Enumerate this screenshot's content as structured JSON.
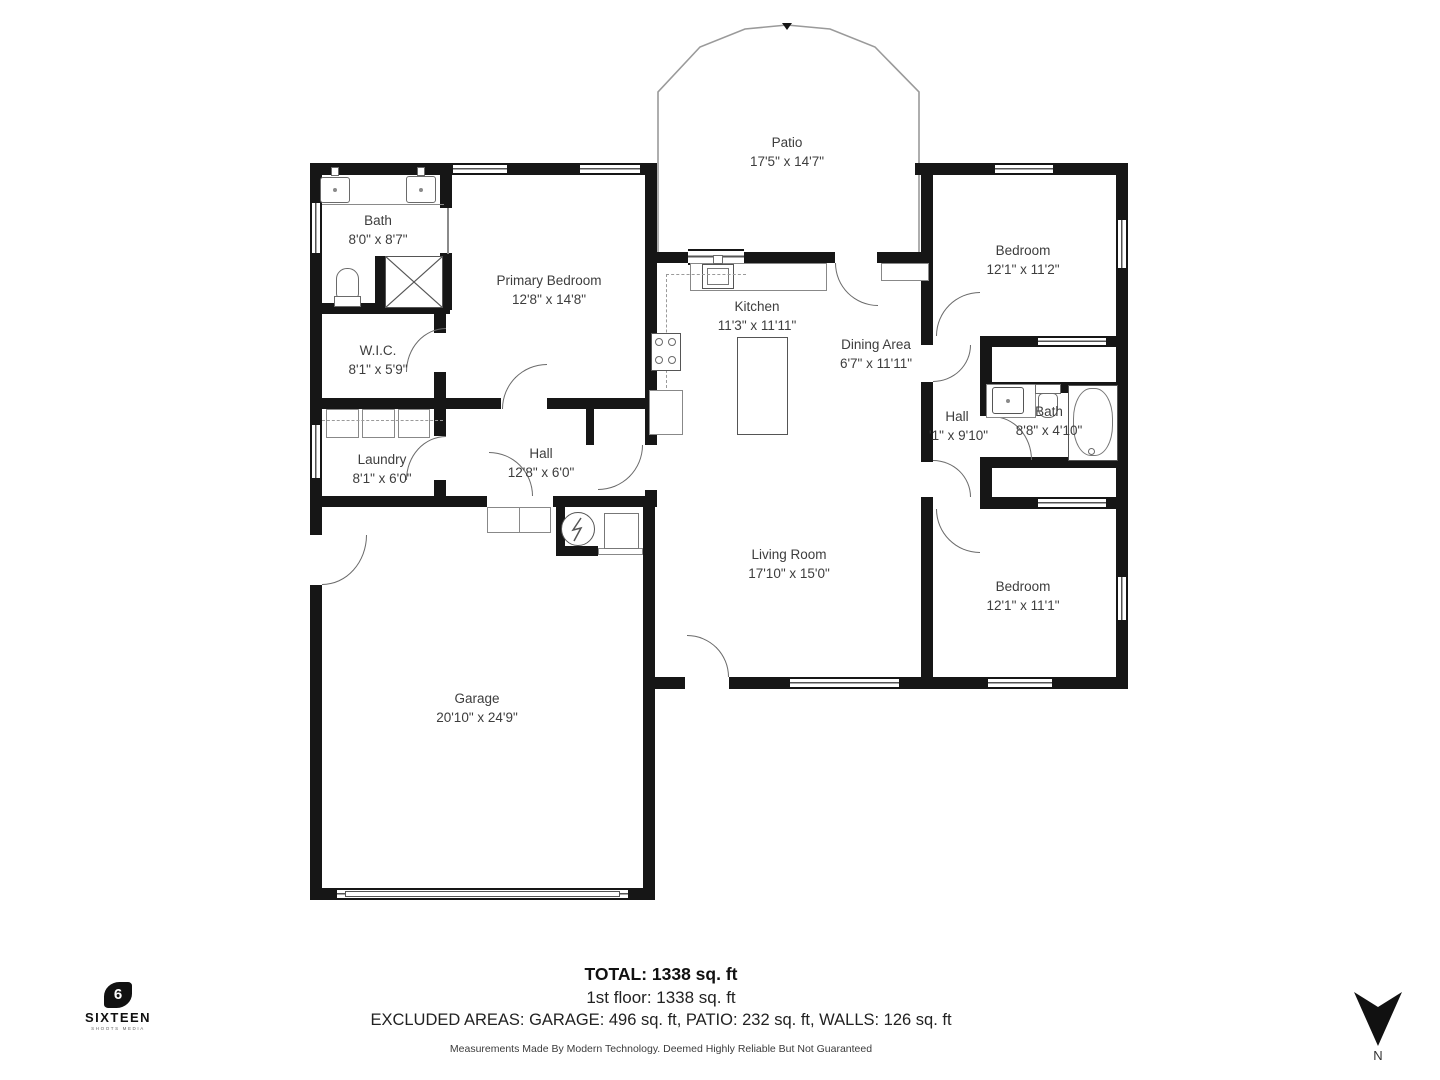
{
  "floor_plan": {
    "rooms": [
      {
        "id": "patio",
        "name": "Patio",
        "dims": "17'5\" x 14'7\""
      },
      {
        "id": "bath_west",
        "name": "Bath",
        "dims": "8'0\" x 8'7\""
      },
      {
        "id": "primary_bedroom",
        "name": "Primary Bedroom",
        "dims": "12'8\" x 14'8\""
      },
      {
        "id": "wic",
        "name": "W.I.C.",
        "dims": "8'1\" x 5'9\""
      },
      {
        "id": "kitchen",
        "name": "Kitchen",
        "dims": "11'3\" x 11'11\""
      },
      {
        "id": "dining",
        "name": "Dining Area",
        "dims": "6'7\" x 11'11\""
      },
      {
        "id": "bedroom_top",
        "name": "Bedroom",
        "dims": "12'1\" x 11'2\""
      },
      {
        "id": "hall_right",
        "name": "Hall",
        "dims": "'1\" x 9'10\""
      },
      {
        "id": "bath_right",
        "name": "Bath",
        "dims": "8'8\" x 4'10\""
      },
      {
        "id": "laundry",
        "name": "Laundry",
        "dims": "8'1\" x 6'0\""
      },
      {
        "id": "hall_west",
        "name": "Hall",
        "dims": "12'8\" x 6'0\""
      },
      {
        "id": "living",
        "name": "Living Room",
        "dims": "17'10\" x 15'0\""
      },
      {
        "id": "bedroom_bottom",
        "name": "Bedroom",
        "dims": "12'1\" x 11'1\""
      },
      {
        "id": "garage",
        "name": "Garage",
        "dims": "20'10\" x 24'9\""
      }
    ],
    "footer": {
      "total": "TOTAL: 1338 sq. ft",
      "floor": "1st floor: 1338 sq. ft",
      "excluded": "EXCLUDED AREAS: GARAGE: 496 sq. ft, PATIO: 232 sq. ft, WALLS: 126 sq. ft",
      "disclaimer": "Measurements Made By Modern Technology. Deemed Highly Reliable But Not Guaranteed"
    },
    "branding": {
      "logo_mark": "6",
      "logo_text": "SIXTEEN",
      "logo_tagline": "SHOOTS MEDIA"
    },
    "compass": {
      "label": "N"
    },
    "colors": {
      "wall": "#161616",
      "text": "#3d3d3d",
      "fixture_line": "#6a6a6a"
    }
  }
}
